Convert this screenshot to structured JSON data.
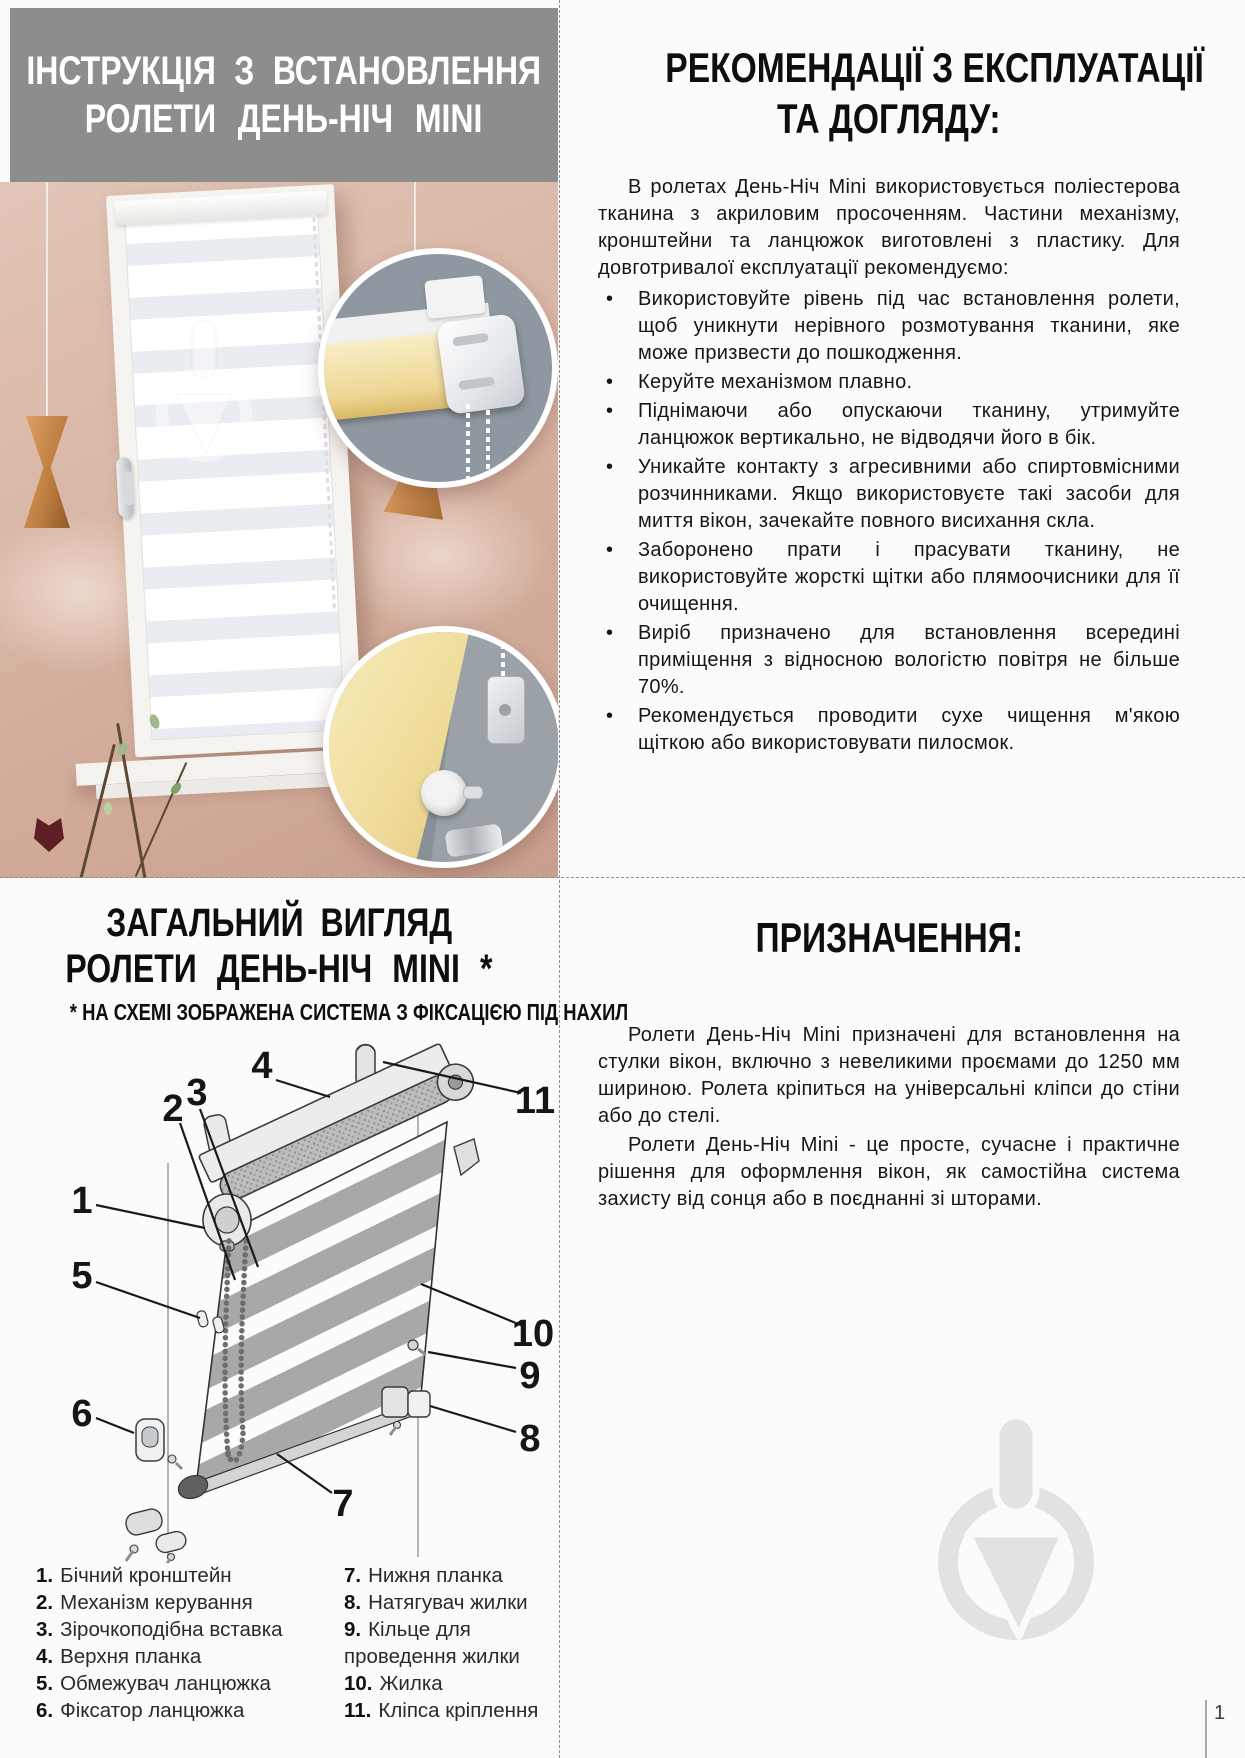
{
  "page": {
    "number": "1"
  },
  "install_header": {
    "line1": "ІНСТРУКЦІЯ З ВСТАНОВЛЕННЯ",
    "line2": "РОЛЕТИ ДЕНЬ-НІЧ MINI"
  },
  "recommendations": {
    "heading_line1": "РЕКОМЕНДАЦІЇ З ЕКСПЛУАТАЦІЇ",
    "heading_line2": "ТА ДОГЛЯДУ:",
    "intro": "В ролетах День-Ніч Mini використовується поліестерова тканина з акриловим просоченням. Частини механізму, кронштейни та ланцюжок виготовлені з пластику. Для довготривалої експлуатації рекомендуємо:",
    "bullets": [
      "Використовуйте рівень під час встановлення ролети, щоб уникнути нерівного розмотування тканини, яке може призвести до пошкодження.",
      "Керуйте механізмом плавно.",
      "Піднімаючи або опускаючи тканину, утримуйте ланцюжок вертикально, не відводячи його в бік.",
      "Уникайте контакту з агресивними або спиртовмісними розчинниками. Якщо використовуєте такі засоби для миття вікон, зачекайте повного висихання скла.",
      "Заборонено прати і прасувати тканину, не використовуйте жорсткі щітки або плямоочисники для її очищення.",
      "Виріб призначено для встановлення всередині приміщення з відносною вологістю повітря не більше 70%.",
      "Рекомендується проводити сухе чищення м'якою щіткою або використовувати пилосмок."
    ]
  },
  "overview": {
    "heading_line1": "ЗАГАЛЬНИЙ ВИГЛЯД",
    "heading_line2": "РОЛЕТИ ДЕНЬ-НІЧ MINI *",
    "note": "* НА СХЕМІ ЗОБРАЖЕНА СИСТЕМА З ФІКСАЦІЄЮ ПІД НАХИЛ",
    "callouts": [
      "1",
      "2",
      "3",
      "4",
      "5",
      "6",
      "7",
      "8",
      "9",
      "10",
      "11"
    ],
    "legend_col1": [
      {
        "num": "1.",
        "label": "Бічний кронштейн"
      },
      {
        "num": "2.",
        "label": "Механізм керування"
      },
      {
        "num": "3.",
        "label": "Зірочкоподібна вставка"
      },
      {
        "num": "4.",
        "label": "Верхня планка"
      },
      {
        "num": "5.",
        "label": "Обмежувач ланцюжка"
      },
      {
        "num": "6.",
        "label": "Фіксатор ланцюжка"
      }
    ],
    "legend_col2": [
      {
        "num": "7.",
        "label": "Нижня планка"
      },
      {
        "num": "8.",
        "label": "Натягувач жилки"
      },
      {
        "num": "9.",
        "label": "Кільце для проведення жилки"
      },
      {
        "num": "10.",
        "label": "Жилка"
      },
      {
        "num": "11.",
        "label": "Кліпса кріплення"
      }
    ]
  },
  "purpose": {
    "heading": "ПРИЗНАЧЕННЯ:",
    "p1": "Ролети День-Ніч Mini призначені для встановлення на стулки вікон, включно з невеликими проємами до 1250 мм шириною. Ролета кріпиться на універсальні кліпси до стіни або до стелі.",
    "p2": "Ролети День-Ніч Mini - це просте, сучасне і практичне рішення для оформлення вікон, як самостійна система захисту від сонця або в поєднанні зі шторами."
  },
  "colors": {
    "header_gray": "#8d8d8d",
    "wall_pink": "#d9b6a5",
    "blind_yellow": "#eed795",
    "inset_bg_gray": "#8f98a0",
    "watermark_gray": "#e2e2e2",
    "text_black": "#161616"
  }
}
